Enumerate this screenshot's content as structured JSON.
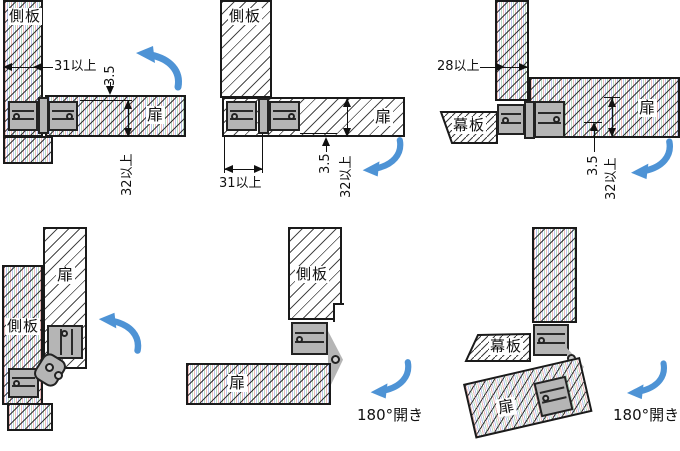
{
  "colors": {
    "arrow": "#4e93d5",
    "hinge": "#b5b5b5",
    "outline": "#1a1a1a"
  },
  "panels": [
    {
      "position": "top-left",
      "side_panel_label": "側板",
      "door_label": "扉",
      "dim_side_thickness": "31以上",
      "dim_offset": "3.5",
      "dim_door_depth": "32以上"
    },
    {
      "position": "top-middle",
      "side_panel_label": "側板",
      "door_label": "扉",
      "dim_side_thickness": "31以上",
      "dim_offset": "3.5",
      "dim_door_depth": "32以上"
    },
    {
      "position": "top-right",
      "makuita_label": "幕板",
      "door_label": "扉",
      "dim_side_thickness": "28以上",
      "dim_offset": "3.5",
      "dim_door_depth": "32以上"
    },
    {
      "position": "bottom-left",
      "side_panel_label": "側板",
      "door_label": "扉"
    },
    {
      "position": "bottom-middle",
      "side_panel_label": "側板",
      "door_label": "扉",
      "caption": "180°開き"
    },
    {
      "position": "bottom-right",
      "side_panel_label": "側板",
      "makuita_label": "幕板",
      "door_label": "扉",
      "caption": "180°開き"
    }
  ]
}
